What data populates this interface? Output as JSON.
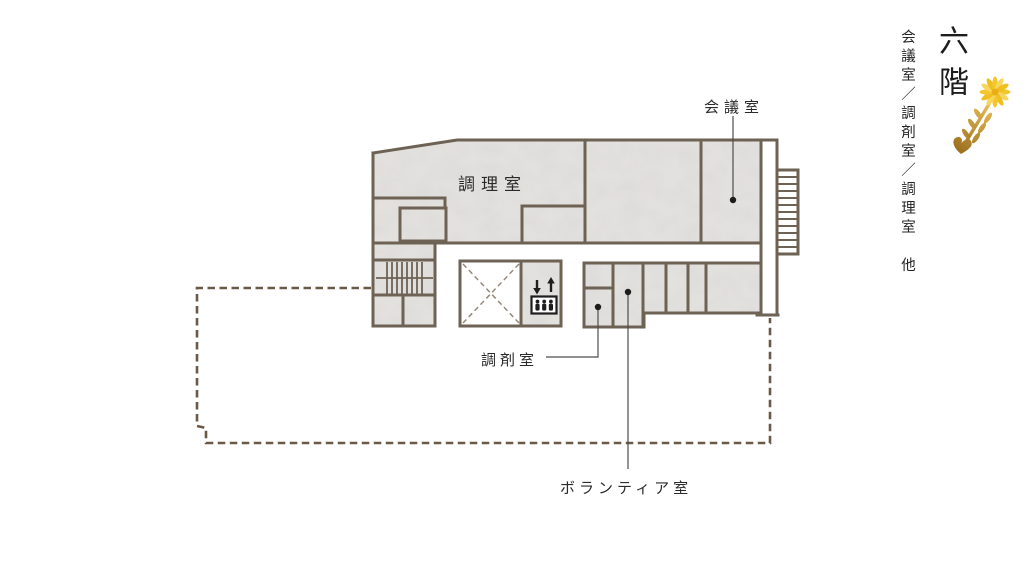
{
  "side_panel": {
    "floor_title": "六階",
    "floor_subtitle": "会議室／調剤室／調理室　他",
    "flower_icon": "yellow-flower-sprig-icon"
  },
  "floorplan": {
    "labels": {
      "cooking_room": "調理室",
      "meeting_room": "会議室",
      "dispensing_room": "調剤室",
      "volunteer_room": "ボランティア室"
    },
    "icons": {
      "elevator": "elevator-icon",
      "inner_stairs": "staircase-icon",
      "outer_stairs": "exterior-staircase-icon",
      "void_shaft": "void-x-icon"
    },
    "colors": {
      "wall": "#6e6254",
      "room_fill": "#e3e1de",
      "footprint_dash": "#6b5947",
      "leader_line": "#4d4d4d",
      "flower_petal": "#f4c62e",
      "flower_stem": "#b5802b"
    }
  }
}
